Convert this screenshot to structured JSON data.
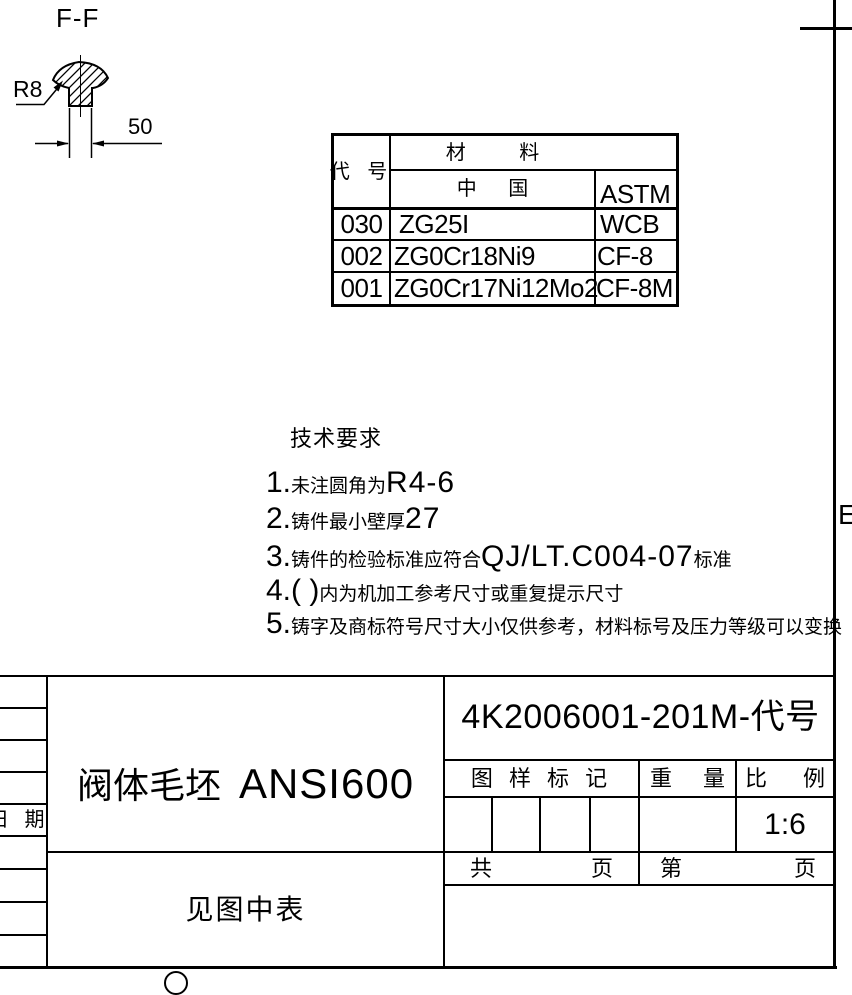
{
  "frame": {
    "zone_letter": "E"
  },
  "section_view": {
    "label": "F-F",
    "radius_label": "R8",
    "width_dim": "50"
  },
  "material_table": {
    "header_code": "代 号",
    "header_material": "材 料",
    "header_china": "中 国",
    "header_astm": "ASTM",
    "rows": [
      {
        "code": "030",
        "china": "ZG25I",
        "astm": "WCB"
      },
      {
        "code": "002",
        "china": "ZG0Cr18Ni9",
        "astm": "CF-8"
      },
      {
        "code": "001",
        "china": "ZG0Cr17Ni12Mo2",
        "astm": "CF-8M"
      }
    ]
  },
  "tech": {
    "title": "技术要求",
    "items": [
      {
        "num": "1.",
        "zh1": "未注圆角为",
        "lat": "R4-6",
        "zh2": ""
      },
      {
        "num": "2.",
        "zh1": "铸件最小壁厚",
        "lat": "27",
        "zh2": ""
      },
      {
        "num": "3.",
        "zh1": "铸件的检验标准应符合",
        "lat": "QJ/LT.C004-07",
        "zh2": "标准"
      },
      {
        "num": "4.( )",
        "zh1": "内为机加工参考尺寸或重复提示尺寸",
        "lat": "",
        "zh2": ""
      },
      {
        "num": "5.",
        "zh1": "铸字及商标符号尺寸大小仅供参考，材料标号及压力等级可以变换",
        "lat": "",
        "zh2": ""
      }
    ]
  },
  "title_block": {
    "part_name_zh": "阀体毛坯",
    "part_name_std": "ANSI600",
    "drawing_no": "4K2006001-201M-代号",
    "label_mark": "图 样 标 记",
    "label_weight_l": "重",
    "label_weight_r": "量",
    "label_scale_l": "比",
    "label_scale_r": "例",
    "scale_value": "1:6",
    "label_total_l": "共",
    "label_total_r": "页",
    "label_page_l": "第",
    "label_page_r": "页",
    "material_note": "见图中表",
    "label_date": "日 期"
  }
}
